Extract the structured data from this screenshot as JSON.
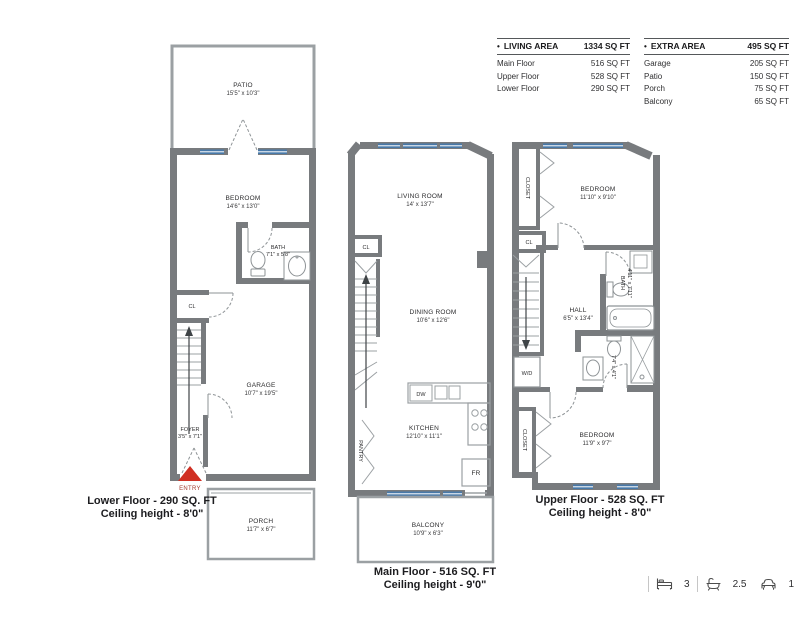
{
  "legend": {
    "living": {
      "bullet": "•",
      "title": "LIVING AREA",
      "total": "1334 SQ FT",
      "rows": [
        {
          "label": "Main Floor",
          "value": "516 SQ FT"
        },
        {
          "label": "Upper Floor",
          "value": "528 SQ FT"
        },
        {
          "label": "Lower Floor",
          "value": "290 SQ FT"
        }
      ]
    },
    "extra": {
      "bullet": "•",
      "title": "EXTRA AREA",
      "total": "495 SQ FT",
      "rows": [
        {
          "label": "Garage",
          "value": "205 SQ FT"
        },
        {
          "label": "Patio",
          "value": "150 SQ FT"
        },
        {
          "label": "Porch",
          "value": "75 SQ FT"
        },
        {
          "label": "Balcony",
          "value": "65 SQ FT"
        }
      ]
    }
  },
  "plans": {
    "lower": {
      "caption1": "Lower Floor - 290 SQ. FT",
      "caption2": "Ceiling height - 8'0\"",
      "entry": "ENTRY",
      "patio_name": "PATIO",
      "patio_dims": "15'5\" x 10'3\"",
      "bedroom_name": "BEDROOM",
      "bedroom_dims": "14'6\" x 13'0\"",
      "bath_name": "BATH",
      "bath_dims": "7'1\" x 5'8\"",
      "cl": "CL",
      "garage_name": "GARAGE",
      "garage_dims": "10'7\" x 19'5\"",
      "foyer_name": "FOYER",
      "foyer_dims": "3'5\" x 7'1\"",
      "porch_name": "PORCH",
      "porch_dims": "11'7\" x 6'7\""
    },
    "main": {
      "caption1": "Main Floor - 516 SQ. FT",
      "caption2": "Ceiling height - 9'0\"",
      "living_name": "LIVING ROOM",
      "living_dims": "14' x 13'7\"",
      "cl": "CL",
      "dining_name": "DINING ROOM",
      "dining_dims": "10'6\" x 12'6\"",
      "kitchen_name": "KITCHEN",
      "kitchen_dims": "12'10\" x 11'1\"",
      "pantry": "PANTRY",
      "dw": "DW",
      "fr": "FR",
      "balcony_name": "BALCONY",
      "balcony_dims": "10'9\" x 6'3\""
    },
    "upper": {
      "caption1": "Upper Floor - 528 SQ. FT",
      "caption2": "Ceiling height - 8'0\"",
      "closet_top": "CLOSET",
      "closet_bottom": "CLOSET",
      "cl": "CL",
      "wd": "W/D",
      "bedroom_top_name": "BEDROOM",
      "bedroom_top_dims": "11'10\" x 9'10\"",
      "hall_name": "HALL",
      "hall_dims": "6'5\" x 13'4\"",
      "bath_name": "BATH",
      "bath_dims": "4'11\" x 7'11\"",
      "ensuite_dims": "7'4\" x 4'1\"",
      "bedroom_bottom_name": "BEDROOM",
      "bedroom_bottom_dims": "11'9\" x 9'7\""
    }
  },
  "stats": {
    "beds": "3",
    "baths": "2.5",
    "parking": "1"
  },
  "colors": {
    "wall": "#787b7e",
    "window": "#4879a9",
    "entry_red": "#d02f23",
    "outline": "#9ba0a4"
  }
}
